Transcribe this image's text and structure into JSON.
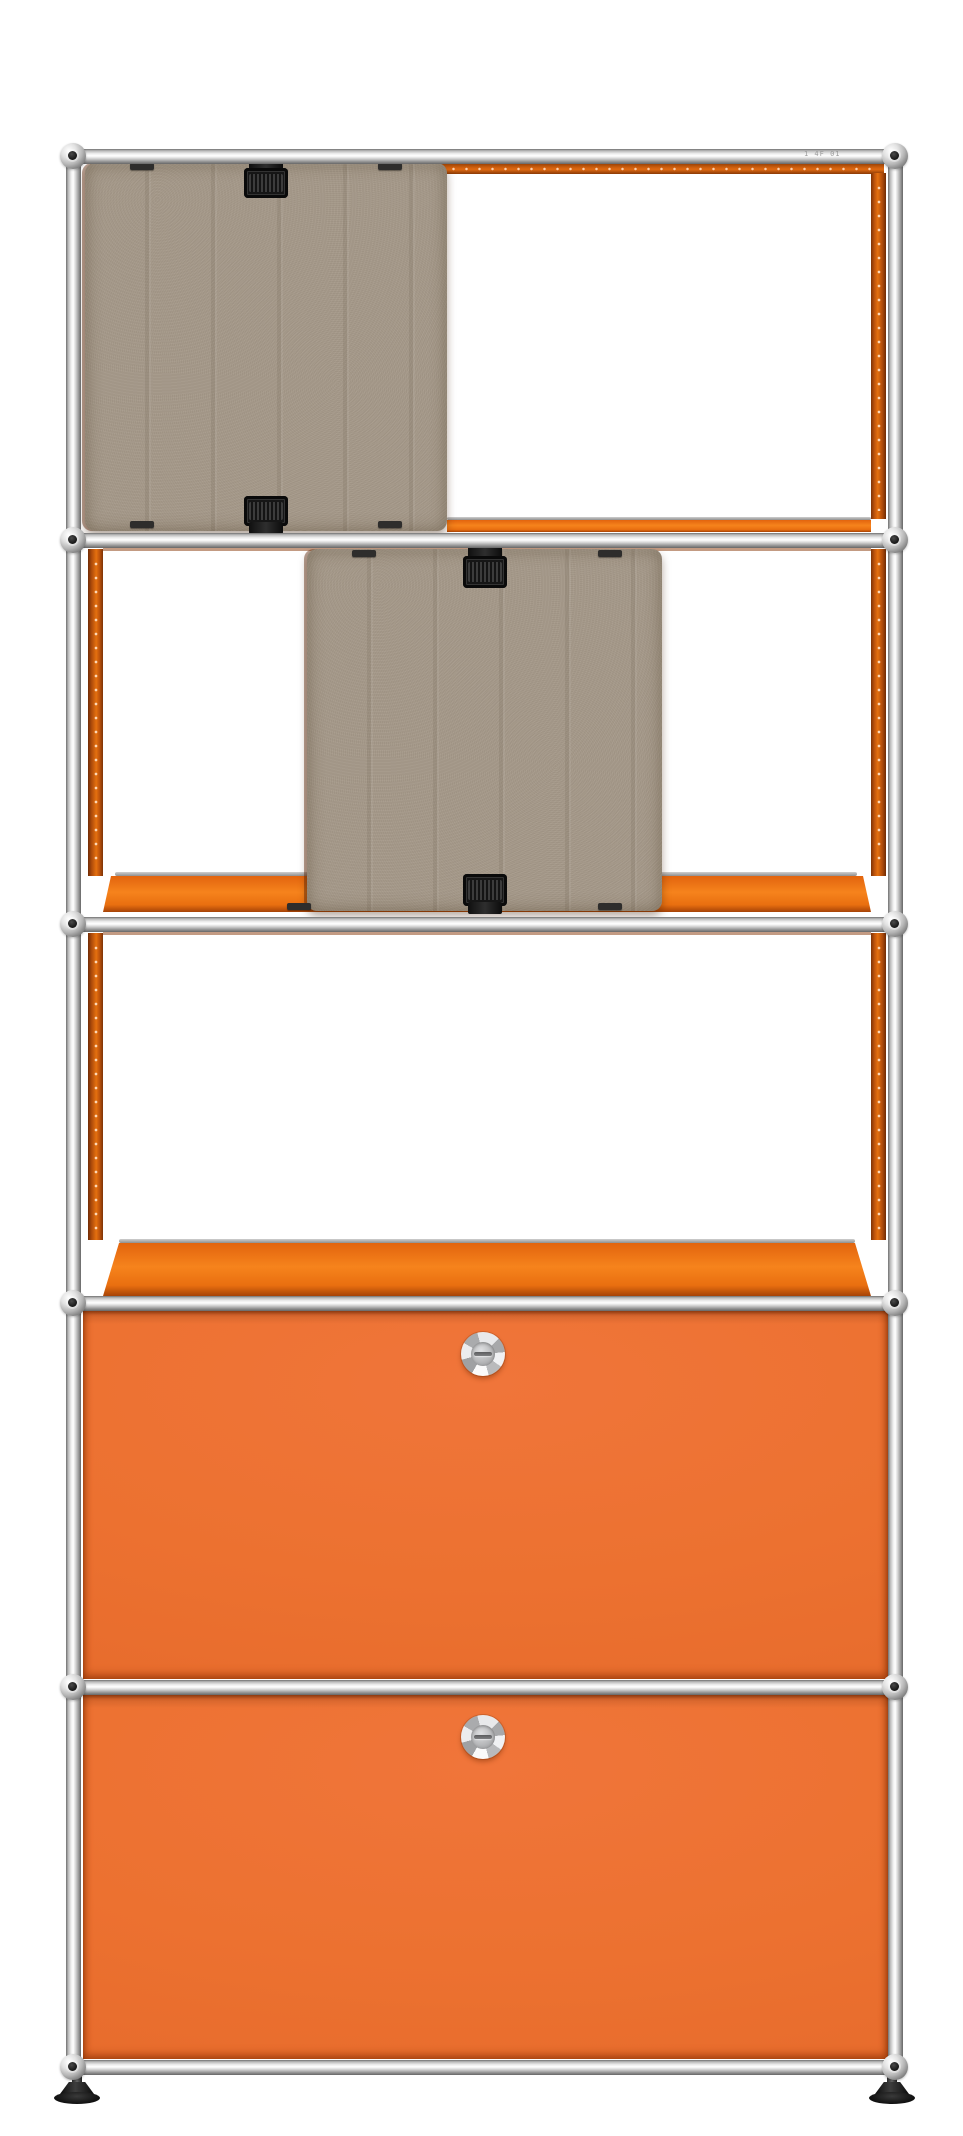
{
  "image": {
    "type": "product-photo",
    "subject": "modular shelving unit",
    "finish": "pure orange panels with chrome tubular frame and taupe felt inserts"
  },
  "frame": {
    "tube_marking": "1 4F 01",
    "connector_count_visible": 12
  },
  "rows": [
    {
      "position": 1,
      "front": "open",
      "insert": "felt acoustic panel, left half",
      "clips_visible": 2
    },
    {
      "position": 2,
      "front": "open",
      "insert": "felt acoustic panel, centered",
      "clips_visible": 2
    },
    {
      "position": 3,
      "front": "open",
      "insert": "none"
    },
    {
      "position": 4,
      "front": "drop-down door",
      "hardware": "round chrome knob"
    },
    {
      "position": 5,
      "front": "drop-down door",
      "hardware": "round chrome knob"
    }
  ],
  "feet_visible": 2,
  "colors": {
    "background": "#ffffff",
    "door_orange": "#ec7130",
    "shelf_orange": "#e2640e",
    "side_edge_orange": "#b04c0b",
    "top_edge_orange": "#cf5f0e",
    "felt_taupe": "#a5998a",
    "chrome_light": "#efefef",
    "chrome_dark": "#6f6f6f",
    "clip_black": "#161616",
    "foot_black": "#101010"
  }
}
